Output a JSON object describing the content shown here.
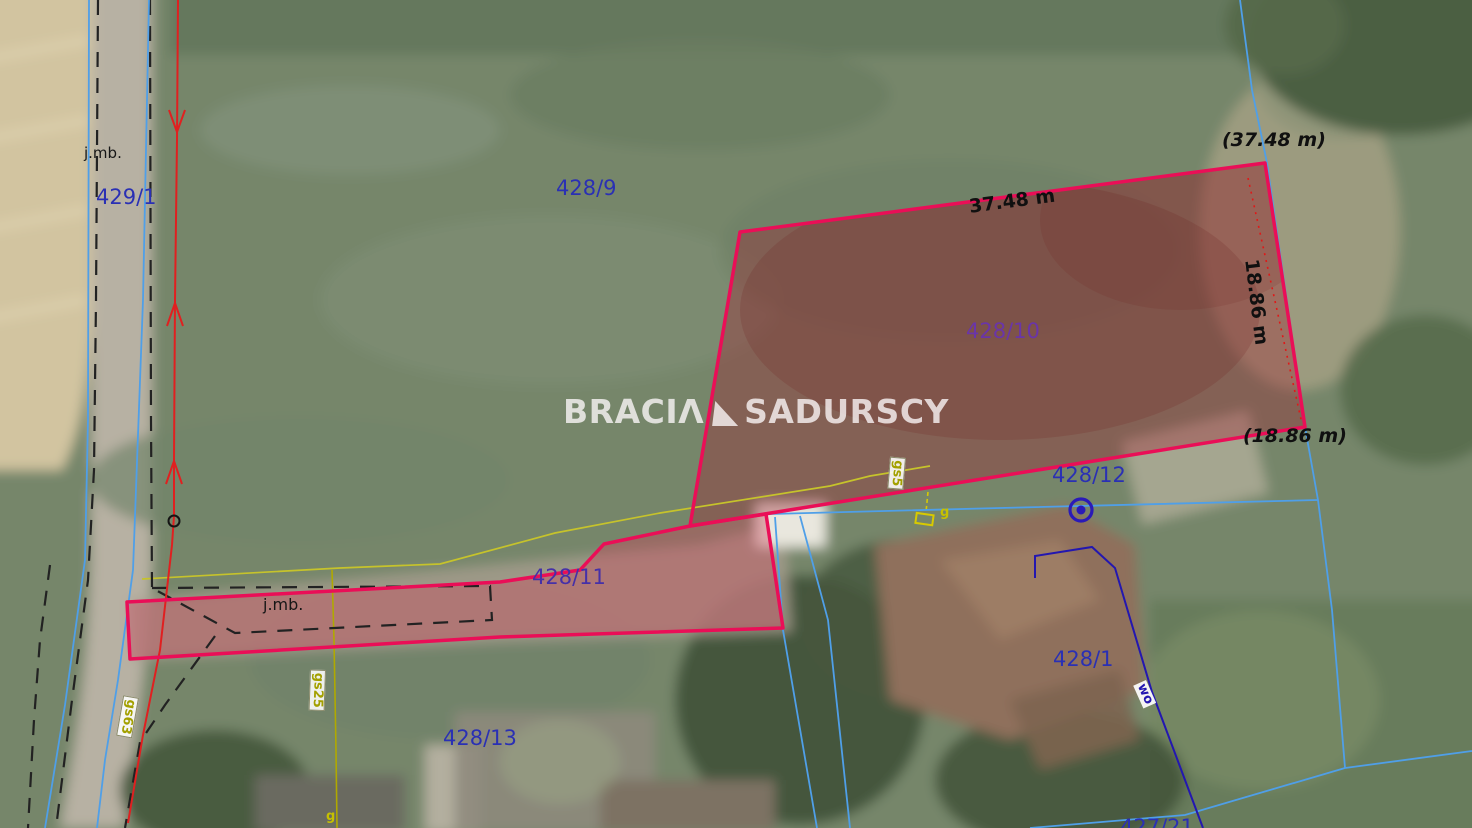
{
  "map_type": "cadastral-parcel-overlay-on-satellite",
  "watermark": {
    "left": "BRACIΛ",
    "right": "SADURSCY"
  },
  "parcels": {
    "p429_1": "429/1",
    "p428_9": "428/9",
    "p428_10": "428/10",
    "p428_11": "428/11",
    "p428_12": "428/12",
    "p428_13": "428/13",
    "p428_1": "428/1",
    "p427_21": "427/21"
  },
  "measurements": {
    "top_edge": "37.48 m",
    "top_edge_paren": "(37.48 m)",
    "right_edge": "18.86 m",
    "right_edge_paren": "(18.86 m)"
  },
  "roads": {
    "jmb_road": "j.mb.",
    "jmb_strip": "j.mb."
  },
  "utilities": {
    "gas_gs63": "gs63",
    "gas_gs25": "gs25",
    "gas_gs5": "gs5",
    "gas_g_house": "g",
    "gas_g_bottom": "g",
    "water_wo": "wo"
  },
  "colors": {
    "parcel_outline": "#ea0e57",
    "parcel_fill": "rgba(160,30,45,0.35)",
    "cadastral_blue": "#4f9fe8",
    "utility_navy": "#2317b0",
    "utility_olive": "#c6c32b",
    "utility_red": "#e02020",
    "dashed_black": "#222222",
    "label_blue": "#2a30b4",
    "label_purple": "#6a35a8",
    "measure_black": "#101010"
  }
}
